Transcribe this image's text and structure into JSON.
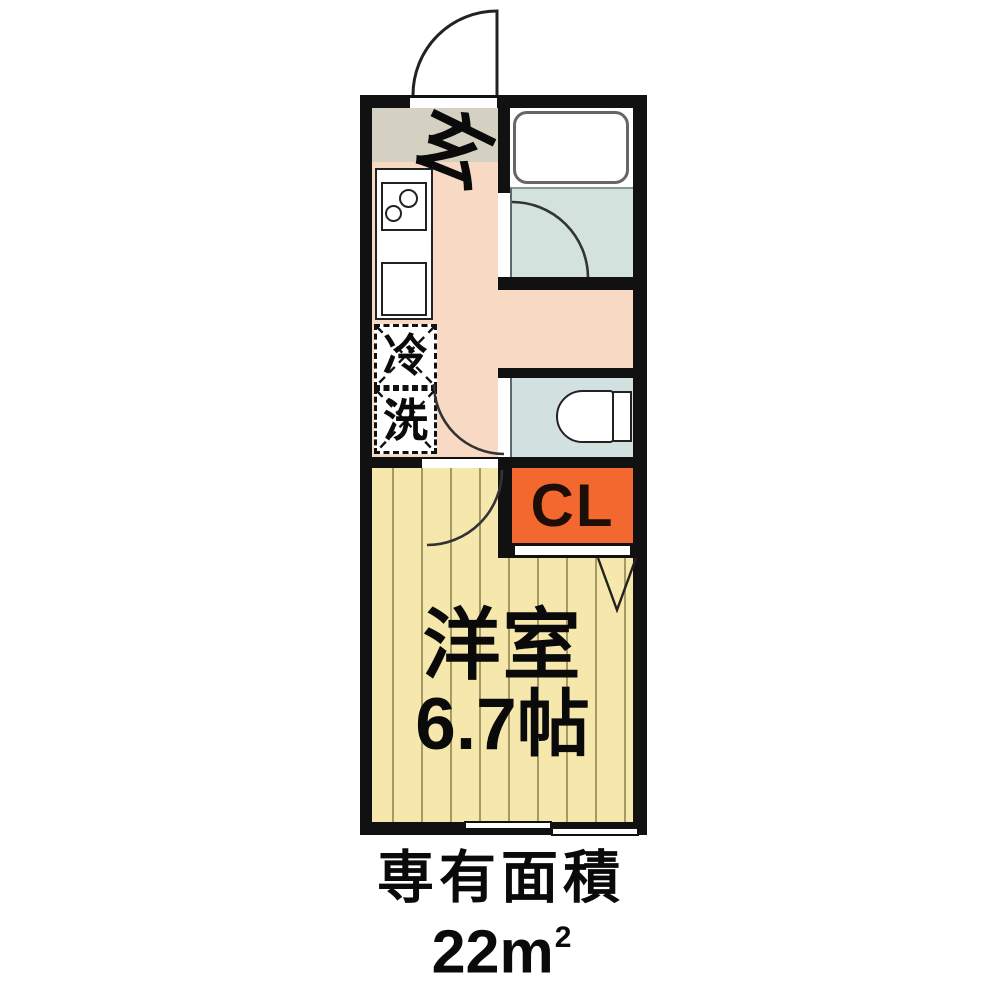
{
  "floorplan": {
    "rooms": {
      "entrance_label": "玄",
      "fridge_label": "冷",
      "washer_label": "洗",
      "closet_label": "CL",
      "main_room_name": "洋室",
      "main_room_size": "6.7帖"
    },
    "caption": {
      "line1": "専有面積",
      "area_value": "22m",
      "area_exponent": "2"
    },
    "colors": {
      "wall": "#111111",
      "entrance_floor": "#d4d1c2",
      "hall_floor": "#f8d9c3",
      "bath_floor": "#d4e2de",
      "toilet_floor": "#d2e0e0",
      "room_floor": "#f6e8ac",
      "room_floor_stripe": "#a59a62",
      "closet_fill": "#f2682f",
      "closet_text": "#1d0f08"
    }
  }
}
